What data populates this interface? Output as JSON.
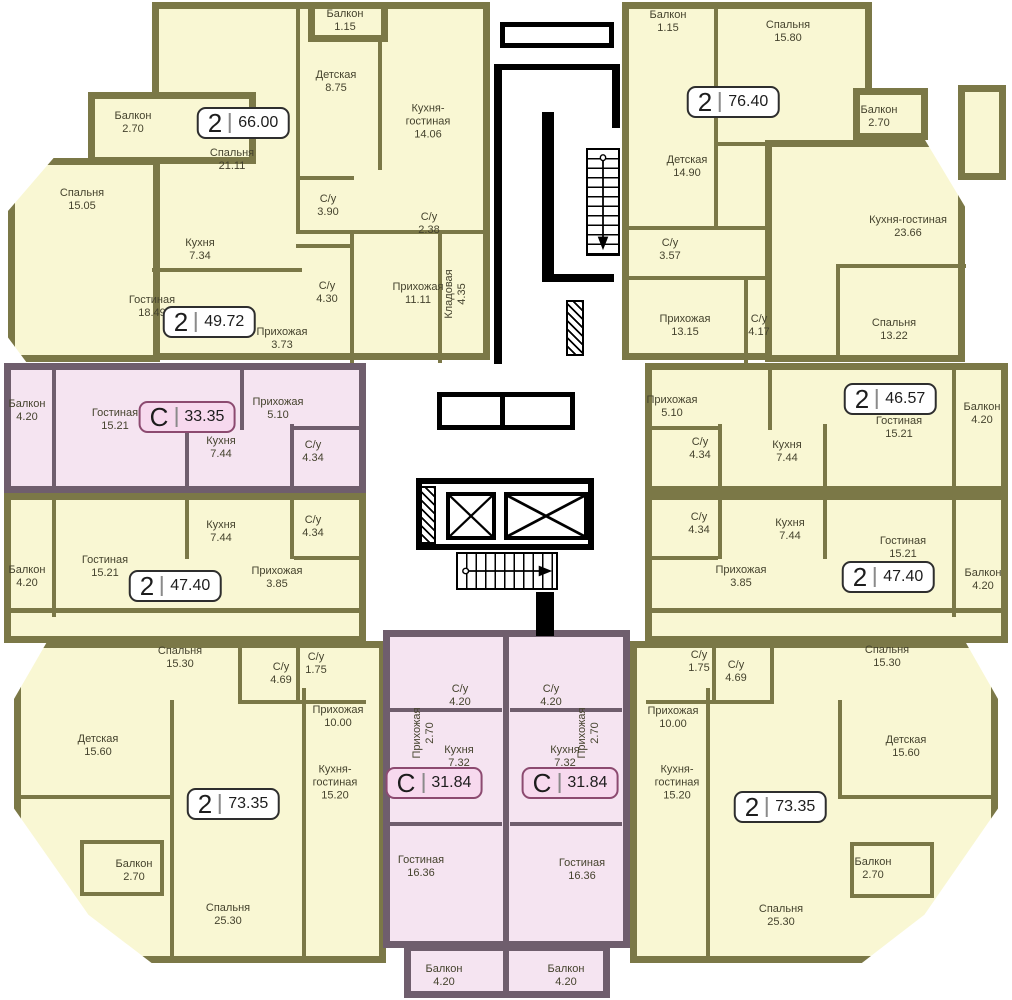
{
  "meta": {
    "width": 1012,
    "height": 1000
  },
  "colors": {
    "yellow": "#f9f7d3",
    "olive": "#7b7847",
    "pink": "#f5e4f1",
    "mauve": "#6f5e6d",
    "ink": "#45432e",
    "core": "#000000",
    "badge_fill": "#ffffff",
    "badge_border": "#2e2e2e",
    "badge_pink_fill": "#f7d9ee",
    "badge_pink_border": "#8c4a70"
  },
  "apartments": [
    {
      "id": "apt-66",
      "type": "2",
      "area": "66.00",
      "studio": false,
      "badge": {
        "x": 243,
        "y": 123
      },
      "rooms": [
        {
          "name": "Балкон",
          "area": "2.70",
          "x": 133,
          "y": 123
        },
        {
          "name": "Спальня",
          "area": "15.05",
          "x": 82,
          "y": 200
        },
        {
          "name": "Спальня",
          "area": "21.11",
          "x": 232,
          "y": 160
        },
        {
          "name": "Балкон",
          "area": "1.15",
          "x": 345,
          "y": 21
        },
        {
          "name": "Детская",
          "area": "8.75",
          "x": 336,
          "y": 82
        },
        {
          "name": "Кухня-\nгостиная",
          "area": "14.06",
          "x": 428,
          "y": 122
        },
        {
          "name": "С/у",
          "area": "3.90",
          "x": 328,
          "y": 206
        },
        {
          "name": "С/у",
          "area": "2.38",
          "x": 429,
          "y": 224
        }
      ]
    },
    {
      "id": "apt-49",
      "type": "2",
      "area": "49.72",
      "studio": false,
      "badge": {
        "x": 209,
        "y": 322
      },
      "rooms": [
        {
          "name": "Кухня",
          "area": "7.34",
          "x": 200,
          "y": 250
        },
        {
          "name": "Гостиная",
          "area": "18.49",
          "x": 152,
          "y": 307
        },
        {
          "name": "С/у",
          "area": "4.30",
          "x": 327,
          "y": 293
        },
        {
          "name": "Прихожая",
          "area": "3.73",
          "x": 282,
          "y": 339
        },
        {
          "name": "Прихожая",
          "area": "11.11",
          "x": 418,
          "y": 294
        },
        {
          "name": "Кладовая",
          "area": "4.35",
          "x": 456,
          "y": 294,
          "vertical": true
        }
      ]
    },
    {
      "id": "studio-33",
      "type": "С",
      "area": "33.35",
      "studio": true,
      "badge": {
        "x": 187,
        "y": 417
      },
      "rooms": [
        {
          "name": "Балкон",
          "area": "4.20",
          "x": 27,
          "y": 411
        },
        {
          "name": "Гостиная",
          "area": "15.21",
          "x": 115,
          "y": 420
        },
        {
          "name": "Прихожая",
          "area": "5.10",
          "x": 278,
          "y": 409
        },
        {
          "name": "Кухня",
          "area": "7.44",
          "x": 221,
          "y": 448
        },
        {
          "name": "С/у",
          "area": "4.34",
          "x": 313,
          "y": 452
        }
      ]
    },
    {
      "id": "apt-47-left",
      "type": "2",
      "area": "47.40",
      "studio": false,
      "badge": {
        "x": 175,
        "y": 586
      },
      "rooms": [
        {
          "name": "Кухня",
          "area": "7.44",
          "x": 221,
          "y": 532
        },
        {
          "name": "С/у",
          "area": "4.34",
          "x": 313,
          "y": 527
        },
        {
          "name": "Гостиная",
          "area": "15.21",
          "x": 105,
          "y": 567
        },
        {
          "name": "Балкон",
          "area": "4.20",
          "x": 27,
          "y": 577
        },
        {
          "name": "Прихожая",
          "area": "3.85",
          "x": 277,
          "y": 578
        },
        {
          "name": "Спальня",
          "area": "15.30",
          "x": 180,
          "y": 658
        },
        {
          "name": "С/у",
          "area": "1.75",
          "x": 316,
          "y": 664
        },
        {
          "name": "С/у",
          "area": "4.69",
          "x": 281,
          "y": 674
        }
      ]
    },
    {
      "id": "apt-73-left",
      "type": "2",
      "area": "73.35",
      "studio": false,
      "badge": {
        "x": 233,
        "y": 804
      },
      "rooms": [
        {
          "name": "Прихожая",
          "area": "10.00",
          "x": 338,
          "y": 717
        },
        {
          "name": "Детская",
          "area": "15.60",
          "x": 98,
          "y": 746
        },
        {
          "name": "Балкон",
          "area": "2.70",
          "x": 134,
          "y": 871
        },
        {
          "name": "Спальня",
          "area": "25.30",
          "x": 228,
          "y": 915
        },
        {
          "name": "Кухня-\nгостиная",
          "area": "15.20",
          "x": 335,
          "y": 783
        }
      ]
    },
    {
      "id": "studio-31-left",
      "type": "С",
      "area": "31.84",
      "studio": true,
      "badge": {
        "x": 434,
        "y": 783
      },
      "rooms": [
        {
          "name": "С/у",
          "area": "4.20",
          "x": 460,
          "y": 696
        },
        {
          "name": "Прихожая",
          "area": "2.70",
          "x": 424,
          "y": 733,
          "vertical": true
        },
        {
          "name": "Кухня",
          "area": "7.32",
          "x": 459,
          "y": 757
        },
        {
          "name": "Гостиная",
          "area": "16.36",
          "x": 421,
          "y": 867
        },
        {
          "name": "Балкон",
          "area": "4.20",
          "x": 444,
          "y": 976
        }
      ]
    },
    {
      "id": "studio-31-right",
      "type": "С",
      "area": "31.84",
      "studio": true,
      "badge": {
        "x": 570,
        "y": 783
      },
      "rooms": [
        {
          "name": "С/у",
          "area": "4.20",
          "x": 551,
          "y": 696
        },
        {
          "name": "Прихожая",
          "area": "2.70",
          "x": 589,
          "y": 733,
          "vertical": true
        },
        {
          "name": "Кухня",
          "area": "7.32",
          "x": 565,
          "y": 757
        },
        {
          "name": "Гостиная",
          "area": "16.36",
          "x": 582,
          "y": 870
        },
        {
          "name": "Балкон",
          "area": "4.20",
          "x": 566,
          "y": 976
        }
      ]
    },
    {
      "id": "apt-76",
      "type": "2",
      "area": "76.40",
      "studio": false,
      "badge": {
        "x": 733,
        "y": 102
      },
      "rooms": [
        {
          "name": "Балкон",
          "area": "1.15",
          "x": 668,
          "y": 22
        },
        {
          "name": "Спальня",
          "area": "15.80",
          "x": 788,
          "y": 32
        },
        {
          "name": "Детская",
          "area": "14.90",
          "x": 687,
          "y": 167
        },
        {
          "name": "Балкон",
          "area": "2.70",
          "x": 879,
          "y": 117
        },
        {
          "name": "Кухня-гостиная",
          "area": "23.66",
          "x": 908,
          "y": 227
        },
        {
          "name": "С/у",
          "area": "3.57",
          "x": 670,
          "y": 250
        },
        {
          "name": "Прихожая",
          "area": "13.15",
          "x": 685,
          "y": 326
        },
        {
          "name": "С/у",
          "area": "4.17",
          "x": 759,
          "y": 326
        }
      ]
    },
    {
      "id": "apt-46",
      "type": "2",
      "area": "46.57",
      "studio": false,
      "badge": {
        "x": 890,
        "y": 399
      },
      "rooms": [
        {
          "name": "Спальня",
          "area": "13.22",
          "x": 894,
          "y": 330
        },
        {
          "name": "Прихожая",
          "area": "5.10",
          "x": 672,
          "y": 407
        },
        {
          "name": "С/у",
          "area": "4.34",
          "x": 700,
          "y": 449
        },
        {
          "name": "Кухня",
          "area": "7.44",
          "x": 787,
          "y": 452
        },
        {
          "name": "Гостиная",
          "area": "15.21",
          "x": 899,
          "y": 428
        },
        {
          "name": "Балкон",
          "area": "4.20",
          "x": 982,
          "y": 414
        }
      ]
    },
    {
      "id": "apt-47-right",
      "type": "2",
      "area": "47.40",
      "studio": false,
      "badge": {
        "x": 888,
        "y": 577
      },
      "rooms": [
        {
          "name": "С/у",
          "area": "4.34",
          "x": 699,
          "y": 524
        },
        {
          "name": "Кухня",
          "area": "7.44",
          "x": 790,
          "y": 530
        },
        {
          "name": "Прихожая",
          "area": "3.85",
          "x": 741,
          "y": 577
        },
        {
          "name": "Гостиная",
          "area": "15.21",
          "x": 903,
          "y": 548
        },
        {
          "name": "Балкон",
          "area": "4.20",
          "x": 983,
          "y": 580
        },
        {
          "name": "С/у",
          "area": "1.75",
          "x": 699,
          "y": 662
        },
        {
          "name": "С/у",
          "area": "4.69",
          "x": 736,
          "y": 672
        },
        {
          "name": "Спальня",
          "area": "15.30",
          "x": 887,
          "y": 657
        }
      ]
    },
    {
      "id": "apt-73-right",
      "type": "2",
      "area": "73.35",
      "studio": false,
      "badge": {
        "x": 780,
        "y": 807
      },
      "rooms": [
        {
          "name": "Прихожая",
          "area": "10.00",
          "x": 673,
          "y": 718
        },
        {
          "name": "Кухня-\nгостиная",
          "area": "15.20",
          "x": 677,
          "y": 783
        },
        {
          "name": "Детская",
          "area": "15.60",
          "x": 906,
          "y": 747
        },
        {
          "name": "Балкон",
          "area": "2.70",
          "x": 873,
          "y": 869
        },
        {
          "name": "Спальня",
          "area": "25.30",
          "x": 781,
          "y": 916
        }
      ]
    }
  ],
  "core": {
    "elevator_count": 2,
    "stair_flights": 2
  }
}
